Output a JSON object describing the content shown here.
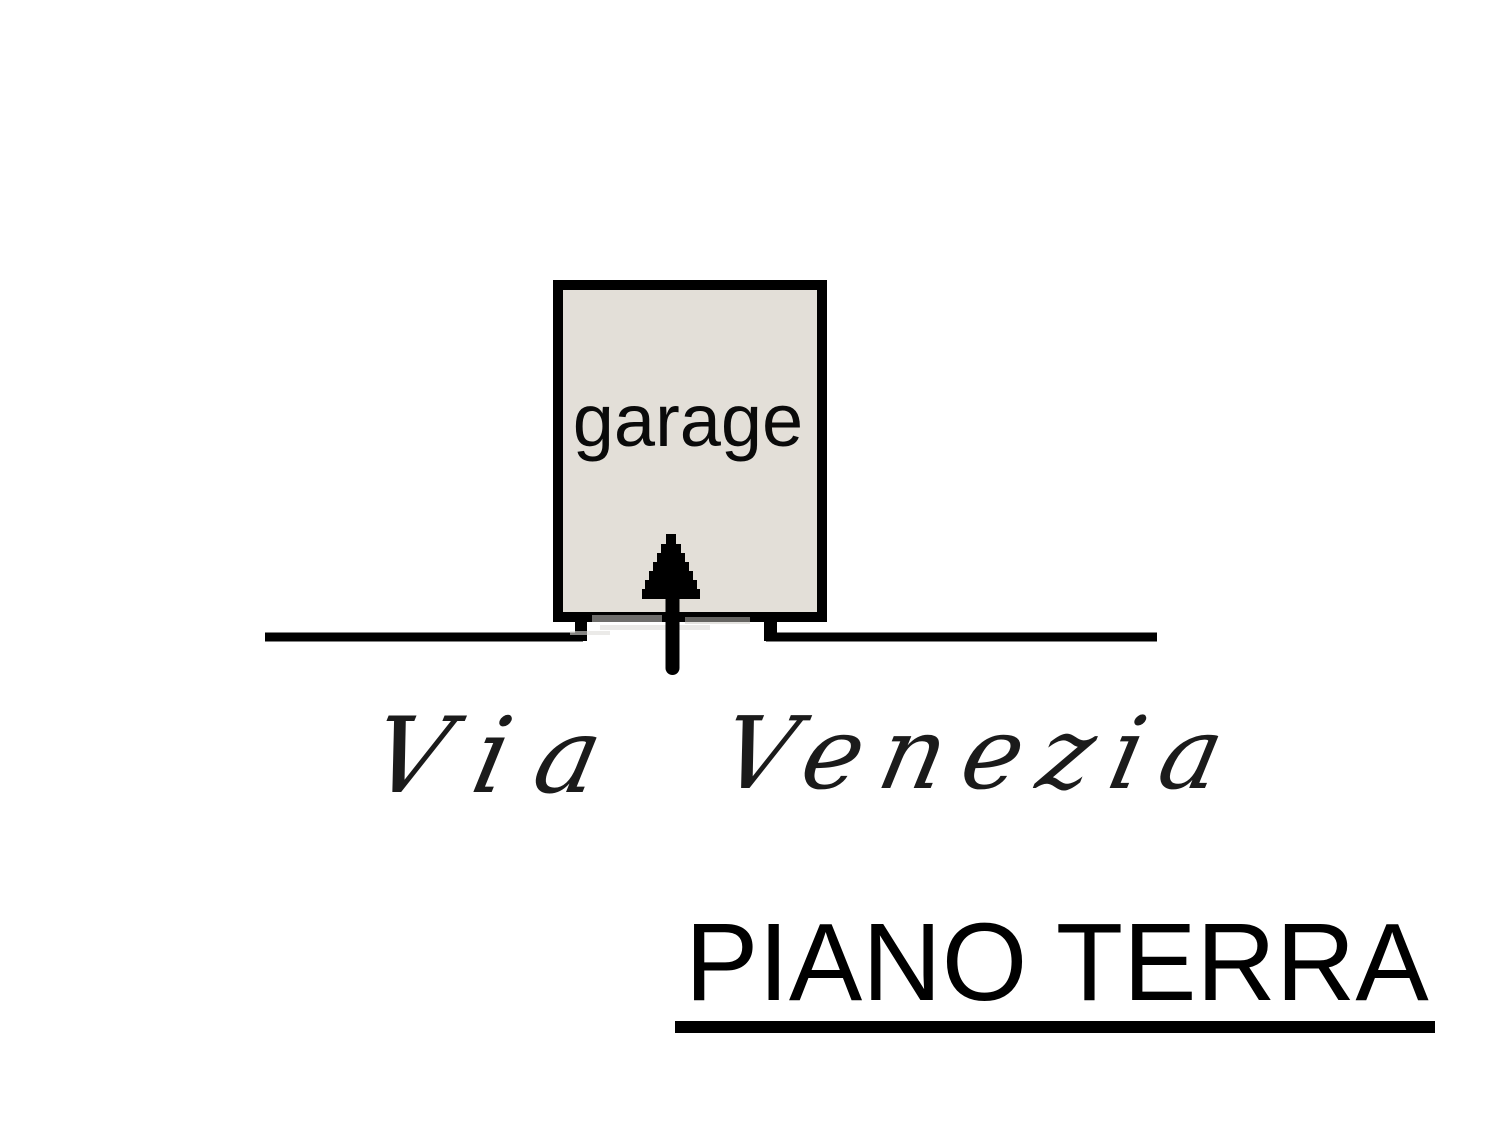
{
  "plan": {
    "room": {
      "label": "garage",
      "fill_color": "#e3dfd8"
    },
    "street": {
      "name": "Via Venezia",
      "word1": "Via",
      "word2": "Venezia"
    },
    "floor_title": "PIANO TERRA"
  },
  "colors": {
    "line": "#000000",
    "handwriting": "#1b1b1b",
    "background": "#ffffff"
  }
}
